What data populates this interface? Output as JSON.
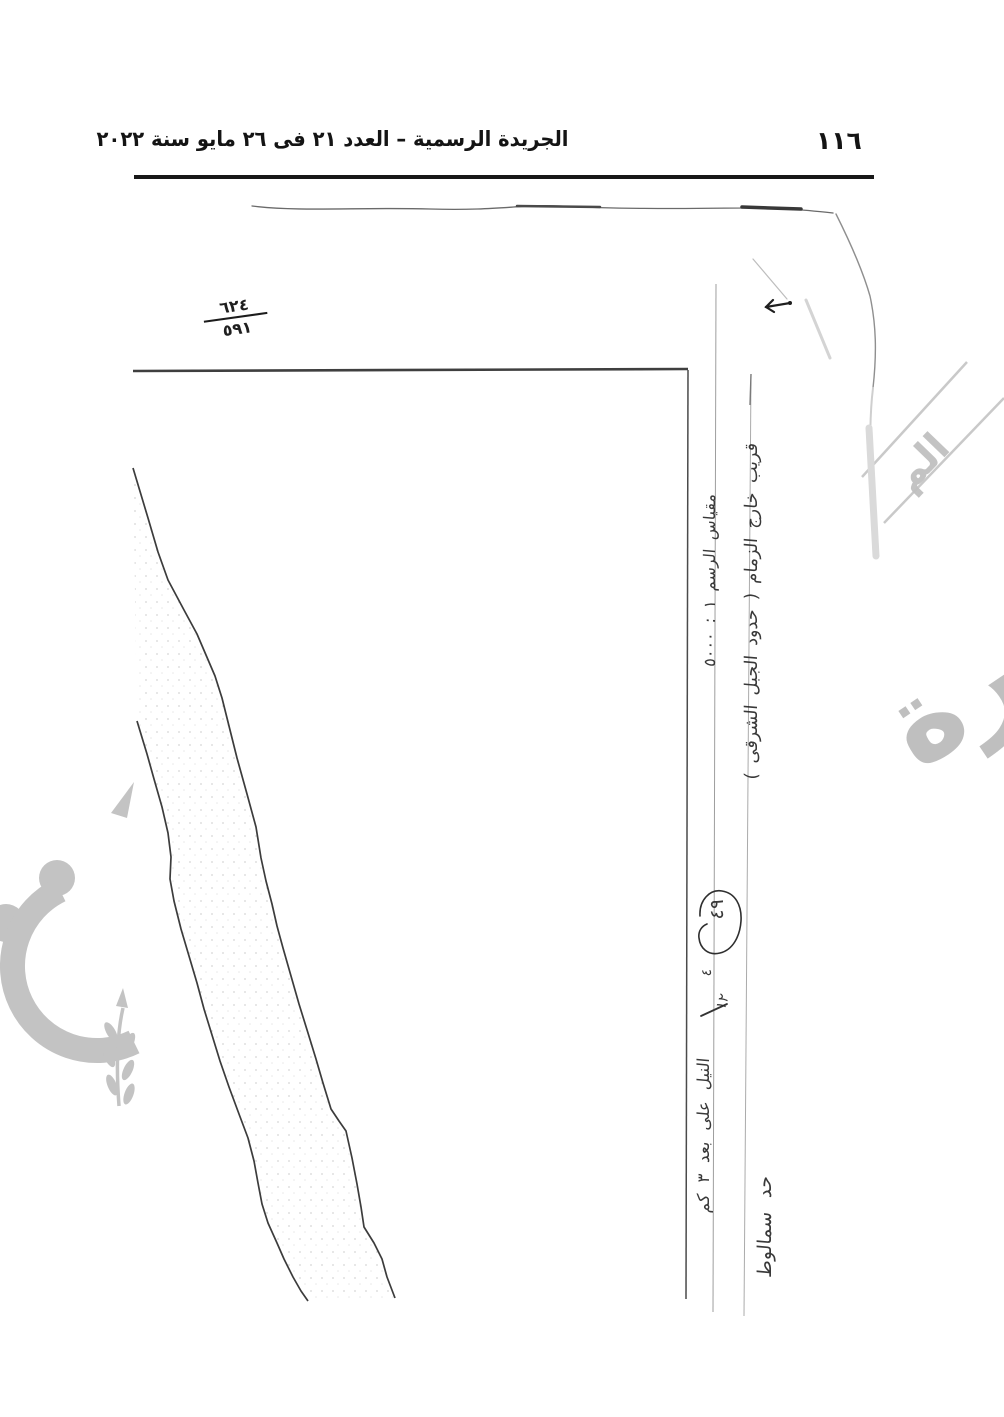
{
  "header": {
    "page_number": "١١٦",
    "title": "الجريدة الرسمية – العدد ٢١ فى ٢٦ مايو سنة ٢٠٢٢"
  },
  "sketch": {
    "plot_fraction": {
      "numerator": "٦٢٤",
      "denominator": "٥٩١"
    },
    "annotations": {
      "outside_zimam": "قريب خارج الزمام ( حدود الجبل الشرقى )",
      "scale": "مقياس الرسم ١ : ٥٠٠٠",
      "circled_number": "٤٩",
      "scribble_a": "٤",
      "scribble_b": "١٢",
      "samalut_boundary": "حد سمالوط",
      "nile_note": "النيل على بعد ٣ كم"
    }
  },
  "watermark": {
    "copy_word": "صورة",
    "stamp_fragment": "الم",
    "color": "#b9b9b9"
  },
  "colors": {
    "ink": "#1a1a1a",
    "faint_line": "#999999",
    "paper": "#ffffff"
  }
}
